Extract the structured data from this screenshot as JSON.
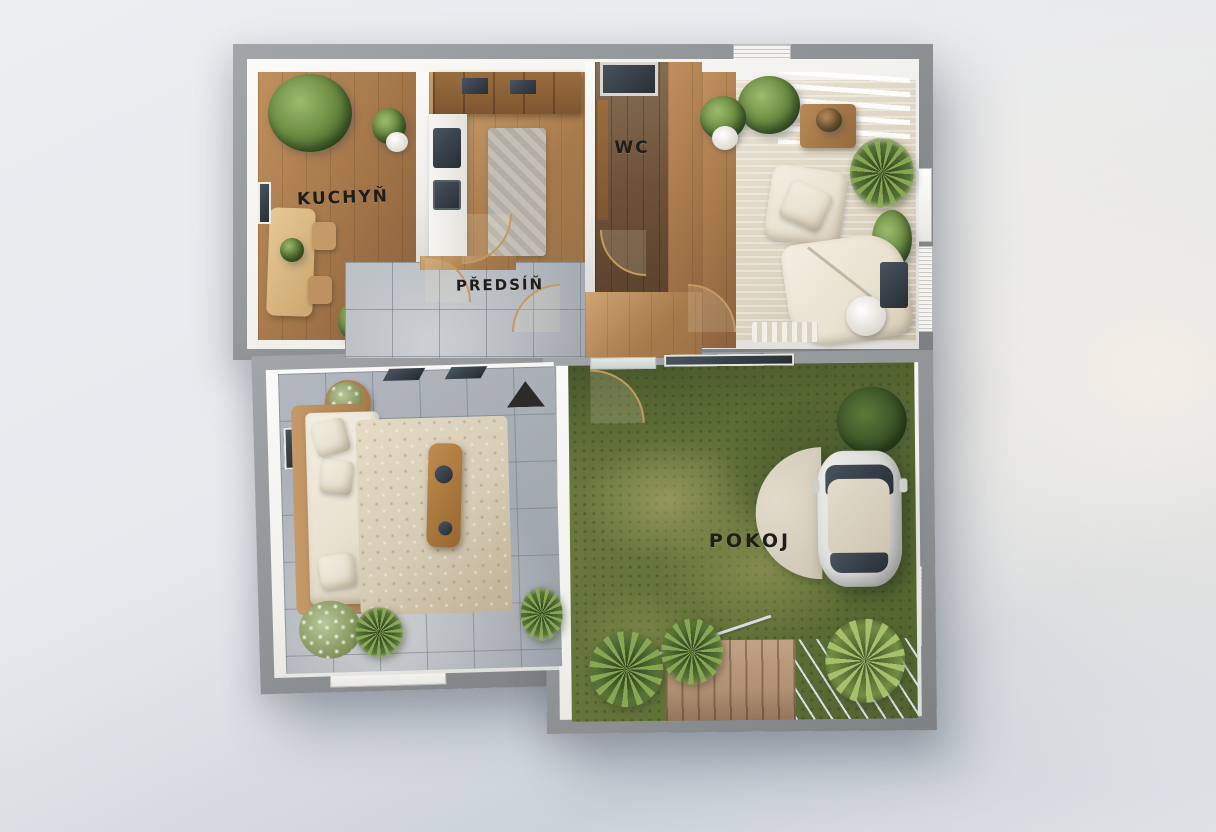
{
  "labels": {
    "kitchen": "KUCHYŇ",
    "wc": "WC",
    "hallway": "PŘEDSÍŇ",
    "room": "POKOJ"
  },
  "colors": {
    "bg-1": "#edeef0",
    "bg-2": "#e7e9ec",
    "bg-3": "#ccd2da",
    "bg-4": "#dfe2e6",
    "bg-warm": "#f2efe7",
    "wall": "#8f9295",
    "wall-light": "#a3a6a9",
    "wall-dark": "#7f8285",
    "inner-wall": "#f0efec",
    "wood": "#a87a4c",
    "wood-light": "#c0905d",
    "wood-dark": "#8a5f3b",
    "wc-wood": "#6e5138",
    "tile": "#9aa0a8",
    "tile-light": "#cdd1d3",
    "carpet": "#dbd2bf",
    "rug": "#d6cbb4",
    "sofa": "#e9e1d0",
    "grass": "#5f7036",
    "deck": "#b29173",
    "plant": "#43602c",
    "door": "#c49a5e",
    "car": "#d9d9d5",
    "label-text": "#1f1d1a"
  }
}
